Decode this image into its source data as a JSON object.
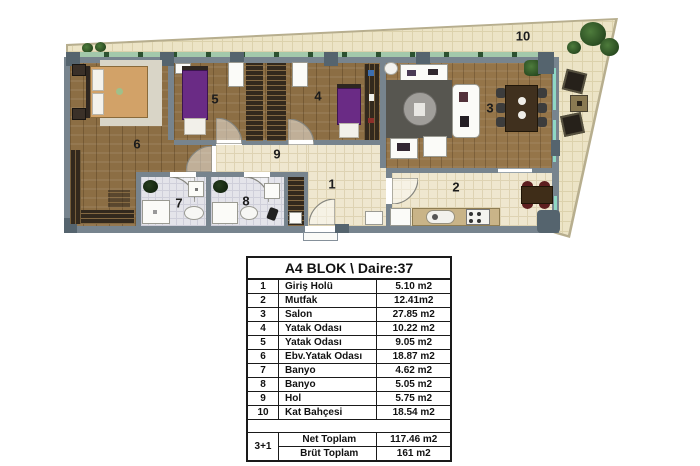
{
  "plan": {
    "room_numbers": {
      "r1": "1",
      "r2": "2",
      "r3": "3",
      "r4": "4",
      "r5": "5",
      "r6": "6",
      "r7": "7",
      "r8": "8",
      "r9": "9",
      "r10": "10"
    }
  },
  "table": {
    "title": "A4 BLOK \\ Daire:37",
    "rows": [
      {
        "num": "1",
        "name": "Giriş Holü",
        "area": "5.10 m2"
      },
      {
        "num": "2",
        "name": "Mutfak",
        "area": "12.41m2"
      },
      {
        "num": "3",
        "name": "Salon",
        "area": "27.85 m2"
      },
      {
        "num": "4",
        "name": "Yatak Odası",
        "area": "10.22 m2"
      },
      {
        "num": "5",
        "name": "Yatak Odası",
        "area": "9.05 m2"
      },
      {
        "num": "6",
        "name": "Ebv.Yatak Odası",
        "area": "18.87 m2"
      },
      {
        "num": "7",
        "name": "Banyo",
        "area": "4.62 m2"
      },
      {
        "num": "8",
        "name": "Banyo",
        "area": "5.05 m2"
      },
      {
        "num": "9",
        "name": "Hol",
        "area": "5.75 m2"
      },
      {
        "num": "10",
        "name": "Kat Bahçesi",
        "area": "18.54 m2"
      }
    ],
    "summary": {
      "type": "3+1",
      "net_label": "Net Toplam",
      "net_value": "117.46 m2",
      "brut_label": "Brüt Toplam",
      "brut_value": "161 m2"
    }
  },
  "colors": {
    "wall": "#77848e",
    "wood": "#8c6e44",
    "tile": "#efe7cf",
    "bath_tile": "#e4e4ea",
    "garden": "#ece4c6",
    "bed_purple": "#6a2b85",
    "window_green": "#a3c9ab",
    "table_border": "#1a1a1a"
  }
}
